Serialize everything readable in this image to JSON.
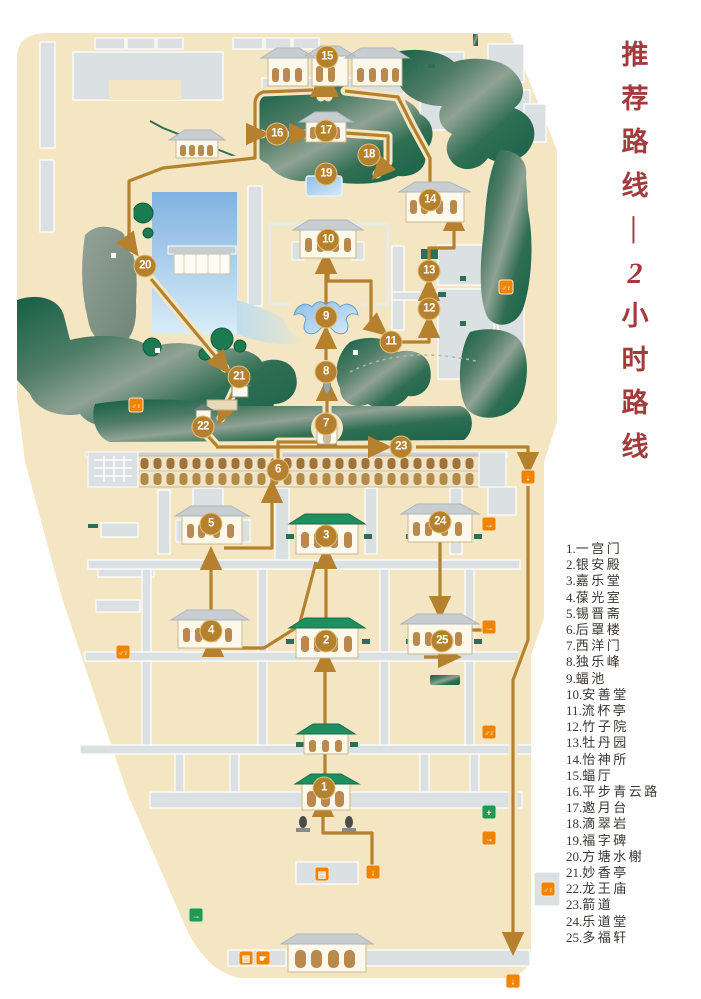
{
  "title": {
    "text": "推荐路线—2小时路线",
    "chars": [
      "推",
      "荐",
      "路",
      "线",
      "—",
      "2",
      "小",
      "时",
      "路",
      "线"
    ],
    "color": "#A33B3D"
  },
  "legend": {
    "items": [
      {
        "n": "1",
        "label": "一宫门"
      },
      {
        "n": "2",
        "label": "银安殿"
      },
      {
        "n": "3",
        "label": "嘉乐堂"
      },
      {
        "n": "4",
        "label": "葆光室"
      },
      {
        "n": "5",
        "label": "锡晋斋"
      },
      {
        "n": "6",
        "label": "后罩楼"
      },
      {
        "n": "7",
        "label": "西洋门"
      },
      {
        "n": "8",
        "label": "独乐峰"
      },
      {
        "n": "9",
        "label": "蝠池"
      },
      {
        "n": "10",
        "label": "安善堂"
      },
      {
        "n": "11",
        "label": "流杯亭"
      },
      {
        "n": "12",
        "label": "竹子院"
      },
      {
        "n": "13",
        "label": "牡丹园"
      },
      {
        "n": "14",
        "label": "怡神所"
      },
      {
        "n": "15",
        "label": "蝠厅"
      },
      {
        "n": "16",
        "label": "平步青云路"
      },
      {
        "n": "17",
        "label": "邀月台"
      },
      {
        "n": "18",
        "label": "滴翠岩"
      },
      {
        "n": "19",
        "label": "福字碑"
      },
      {
        "n": "20",
        "label": "方塘水榭"
      },
      {
        "n": "21",
        "label": "妙香亭"
      },
      {
        "n": "22",
        "label": "龙王庙"
      },
      {
        "n": "23",
        "label": "箭道"
      },
      {
        "n": "24",
        "label": "乐道堂"
      },
      {
        "n": "25",
        "label": "多福轩"
      }
    ]
  },
  "map": {
    "colors": {
      "background": "#F4E6C2",
      "building": "#DBE0E2",
      "rockery": "#1B6549",
      "water": "#8FBCE6",
      "route": "#B5812E",
      "roof_green": "#1F8F60",
      "wall_teal": "#2E6E58",
      "icon_orange": "#F08300",
      "icon_green": "#1F9A50"
    },
    "markers": [
      {
        "n": "1",
        "x": 324,
        "y": 788
      },
      {
        "n": "2",
        "x": 326,
        "y": 641
      },
      {
        "n": "3",
        "x": 326,
        "y": 536
      },
      {
        "n": "4",
        "x": 211,
        "y": 631
      },
      {
        "n": "5",
        "x": 211,
        "y": 524
      },
      {
        "n": "6",
        "x": 278,
        "y": 470
      },
      {
        "n": "7",
        "x": 326,
        "y": 424
      },
      {
        "n": "8",
        "x": 326,
        "y": 372
      },
      {
        "n": "9",
        "x": 326,
        "y": 317
      },
      {
        "n": "10",
        "x": 328,
        "y": 240
      },
      {
        "n": "11",
        "x": 391,
        "y": 342
      },
      {
        "n": "12",
        "x": 429,
        "y": 309
      },
      {
        "n": "13",
        "x": 429,
        "y": 271
      },
      {
        "n": "14",
        "x": 430,
        "y": 200
      },
      {
        "n": "15",
        "x": 327,
        "y": 57
      },
      {
        "n": "16",
        "x": 277,
        "y": 134
      },
      {
        "n": "17",
        "x": 326,
        "y": 131
      },
      {
        "n": "18",
        "x": 369,
        "y": 155
      },
      {
        "n": "19",
        "x": 326,
        "y": 174
      },
      {
        "n": "20",
        "x": 145,
        "y": 266
      },
      {
        "n": "21",
        "x": 239,
        "y": 377
      },
      {
        "n": "22",
        "x": 203,
        "y": 427
      },
      {
        "n": "23",
        "x": 401,
        "y": 447
      },
      {
        "n": "24",
        "x": 440,
        "y": 522
      },
      {
        "n": "25",
        "x": 442,
        "y": 641
      }
    ],
    "icons": [
      {
        "name": "restroom-icon",
        "x": 136,
        "y": 405,
        "bg": "#F08300",
        "glyph": "♂♀",
        "wc": true
      },
      {
        "name": "restroom-icon",
        "x": 506,
        "y": 287,
        "bg": "#F08300",
        "glyph": "♂♀",
        "wc": true
      },
      {
        "name": "restroom-icon",
        "x": 123,
        "y": 652,
        "bg": "#F08300",
        "glyph": "♂♀",
        "wc": true
      },
      {
        "name": "restroom-icon",
        "x": 489,
        "y": 732,
        "bg": "#F08300",
        "glyph": "♂♀",
        "wc": true
      },
      {
        "name": "restroom-icon",
        "x": 548,
        "y": 889,
        "bg": "#F08300",
        "glyph": "♂♀",
        "wc": true
      },
      {
        "name": "passage-down-icon",
        "x": 528,
        "y": 477,
        "bg": "#F08300",
        "glyph": "↓"
      },
      {
        "name": "entrance-door-icon",
        "x": 489,
        "y": 524,
        "bg": "#F08300",
        "glyph": "→"
      },
      {
        "name": "entrance-door-icon",
        "x": 489,
        "y": 627,
        "bg": "#F08300",
        "glyph": "→"
      },
      {
        "name": "ticket-icon",
        "x": 322,
        "y": 874,
        "bg": "#F08300",
        "glyph": "▤"
      },
      {
        "name": "gate-exit-icon",
        "x": 373,
        "y": 872,
        "bg": "#F08300",
        "glyph": "↓"
      },
      {
        "name": "first-aid-icon",
        "x": 489,
        "y": 812,
        "bg": "#1F9A50",
        "glyph": "+"
      },
      {
        "name": "side-door-icon",
        "x": 489,
        "y": 838,
        "bg": "#F08300",
        "glyph": "→"
      },
      {
        "name": "emergency-exit-icon",
        "x": 196,
        "y": 915,
        "bg": "#1F9A50",
        "glyph": "→"
      },
      {
        "name": "ticket-icon",
        "x": 246,
        "y": 958,
        "bg": "#F08300",
        "glyph": "▤"
      },
      {
        "name": "hand-icon",
        "x": 263,
        "y": 958,
        "bg": "#F08300",
        "glyph": "☛"
      },
      {
        "name": "exit-down-icon",
        "x": 513,
        "y": 981,
        "bg": "#F08300",
        "glyph": "↓"
      }
    ]
  }
}
